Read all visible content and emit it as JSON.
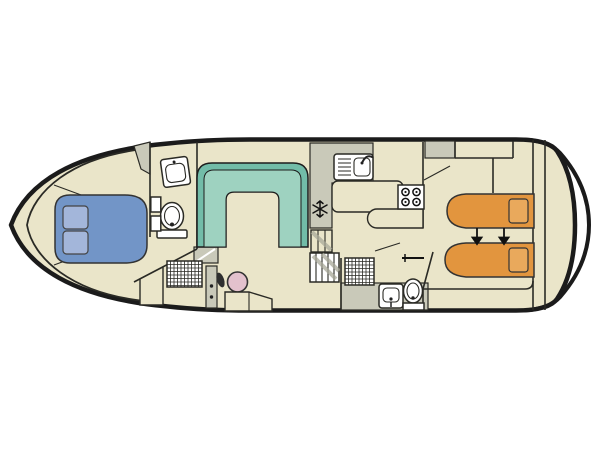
{
  "diagram": {
    "kind": "boat-floor-plan",
    "view": "top-down deck plan",
    "orientation": "bow-left-stern-right",
    "visible_text": []
  },
  "colors": {
    "background": "#ffffff",
    "hull_outline": "#1b1b1b",
    "interior_line": "#2a2a25",
    "deck": "#EAE5C9",
    "gray_area": "#C9C9B9",
    "gray_shadow": "#A8A898",
    "settee_outer": "#72BCA8",
    "settee_inner": "#9ED2C0",
    "bed_double": "#7295C7",
    "pillow_double": "#A3B6DA",
    "bed_single": "#E2953E",
    "pillow_single": "#E9A95C",
    "helm_wheel": "#E3C1CD",
    "fixture_fill": "#ffffff"
  },
  "rooms": [
    {
      "name": "bow-cabin",
      "features": [
        "double-bed",
        "two-pillows"
      ]
    },
    {
      "name": "bow-bathroom",
      "features": [
        "washbasin",
        "toilet",
        "wall-shelves"
      ]
    },
    {
      "name": "bow-shower-room",
      "features": [
        "shower-tray"
      ]
    },
    {
      "name": "saloon",
      "features": [
        "u-shaped-settee"
      ]
    },
    {
      "name": "helm",
      "features": [
        "steering-wheel",
        "console",
        "helm-seat",
        "steps"
      ]
    },
    {
      "name": "galley",
      "features": [
        "sink-with-drainer",
        "four-burner-stove",
        "fridge-freezer",
        "counter",
        "peninsula-worktop",
        "companionway-stairs"
      ]
    },
    {
      "name": "aft-bathroom",
      "features": [
        "shower-tray",
        "washbasin",
        "toilet",
        "door-handle"
      ]
    },
    {
      "name": "aft-cabin",
      "features": [
        "single-bed",
        "single-bed",
        "push-together-arrows",
        "overhead-lockers",
        "wardrobe"
      ]
    },
    {
      "name": "stern-deck",
      "features": [
        "swim-platform-arcs"
      ]
    }
  ],
  "icons": [
    {
      "name": "snowflake-icon",
      "meaning": "refrigerator/freezer"
    },
    {
      "name": "down-arrow-icon",
      "meaning": "beds slide together",
      "count": 2
    },
    {
      "name": "steering-wheel-icon",
      "meaning": "helm position"
    }
  ],
  "counts": {
    "double_beds": 1,
    "single_beds": 2,
    "toilets": 2,
    "washbasins": 3,
    "showers": 2,
    "stoves": 1,
    "settees": 1
  }
}
